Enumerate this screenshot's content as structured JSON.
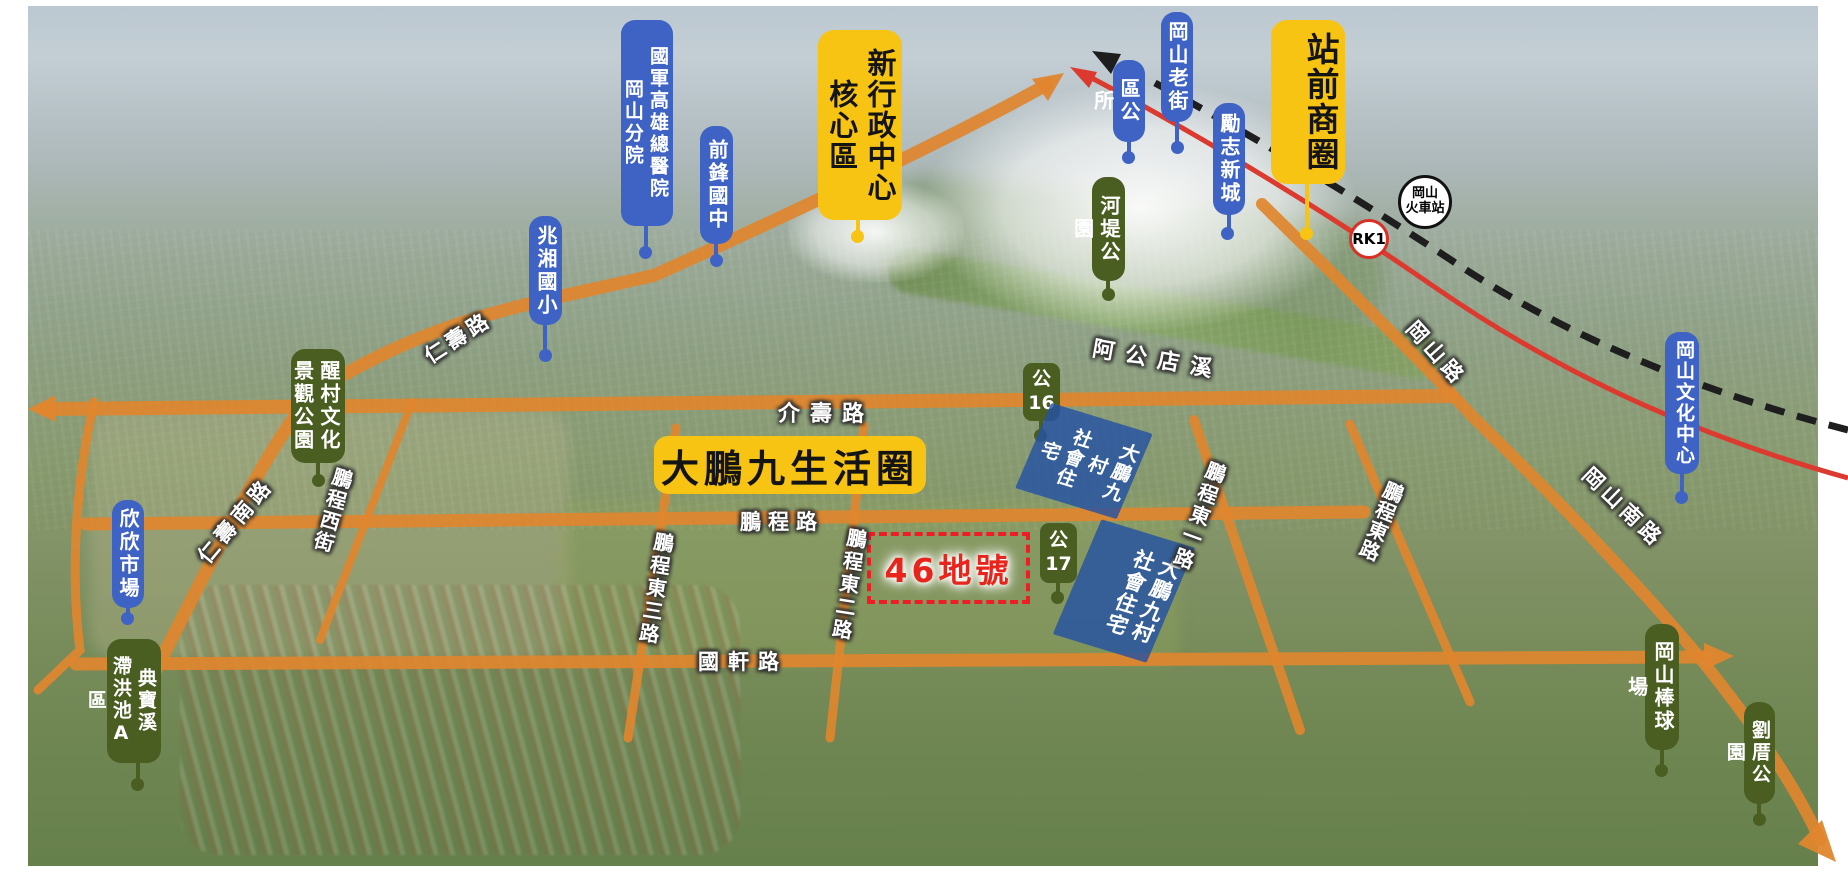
{
  "canvas": {
    "width": 1848,
    "height": 886
  },
  "colors": {
    "label_blue": "#3f63c5",
    "label_green": "#4a5e22",
    "label_yellow": "#f7c414",
    "road_orange": "#e0862e",
    "rail_red": "#dc3a2e",
    "rail_black": "#1e1e1e",
    "site_dash_red": "#ee1c25",
    "site_text_red": "#e8251d",
    "housing_blue": "#2552a4"
  },
  "landmarks": {
    "hospital": {
      "line1": "國軍高雄總醫院",
      "line2": "岡山分院"
    },
    "qianfeng_junior_high": {
      "text": "前鋒國中"
    },
    "zhaoxiang_elementary": {
      "text": "兆湘國小"
    },
    "district_office": {
      "text": "區公所"
    },
    "gangshan_old_street": {
      "text": "岡山老街"
    },
    "lizhi_new_town": {
      "text": "勵志新城"
    },
    "new_admin_center": {
      "line1": "新行政中心",
      "line2": "核心區"
    },
    "station_front_district": {
      "text": "站前商圈"
    },
    "train_station": {
      "line1": "岡山",
      "line2": "火車站"
    },
    "rk1_station": {
      "text": "RK1"
    },
    "riverside_park": {
      "text": "河堤公園"
    },
    "xingcun_culture_park": {
      "line1": "醒村文化",
      "line2": "景觀公園"
    },
    "xinxin_market": {
      "text": "欣欣市場"
    },
    "dianbao_detention_basin": {
      "line1": "典寶溪",
      "line2": "滯洪池A區"
    },
    "park16": {
      "line1": "公",
      "line2": "16"
    },
    "park17": {
      "line1": "公",
      "line2": "17"
    },
    "dapeng_life_circle": {
      "text": "大鵬九生活圈"
    },
    "social_housing_north": {
      "line1": "大鵬九村",
      "line2": "社會住宅"
    },
    "social_housing_south": {
      "line1": "大鵬九村",
      "line2": "社會住宅"
    },
    "site_46": {
      "text": "46地號"
    },
    "culture_center": {
      "text": "岡山文化中心"
    },
    "baseball_stadium": {
      "text": "岡山棒球場"
    },
    "liucuo_park": {
      "text": "劉厝公園"
    }
  },
  "roads": {
    "jieshou": "介壽路",
    "renshou": "仁壽路",
    "renshou_south": "仁壽南路",
    "pengcheng_west_st": "鵬程西街",
    "pengcheng": "鵬程路",
    "pengcheng_e1": "鵬程東一路",
    "pengcheng_e2": "鵬程東二路",
    "pengcheng_e3": "鵬程東三路",
    "pengcheng_e": "鵬程東路",
    "guoxuan": "國軒路",
    "gangshan_rd": "岡山路",
    "gangshan_south_rd": "岡山南路",
    "agongdian_creek": "阿公店溪"
  }
}
